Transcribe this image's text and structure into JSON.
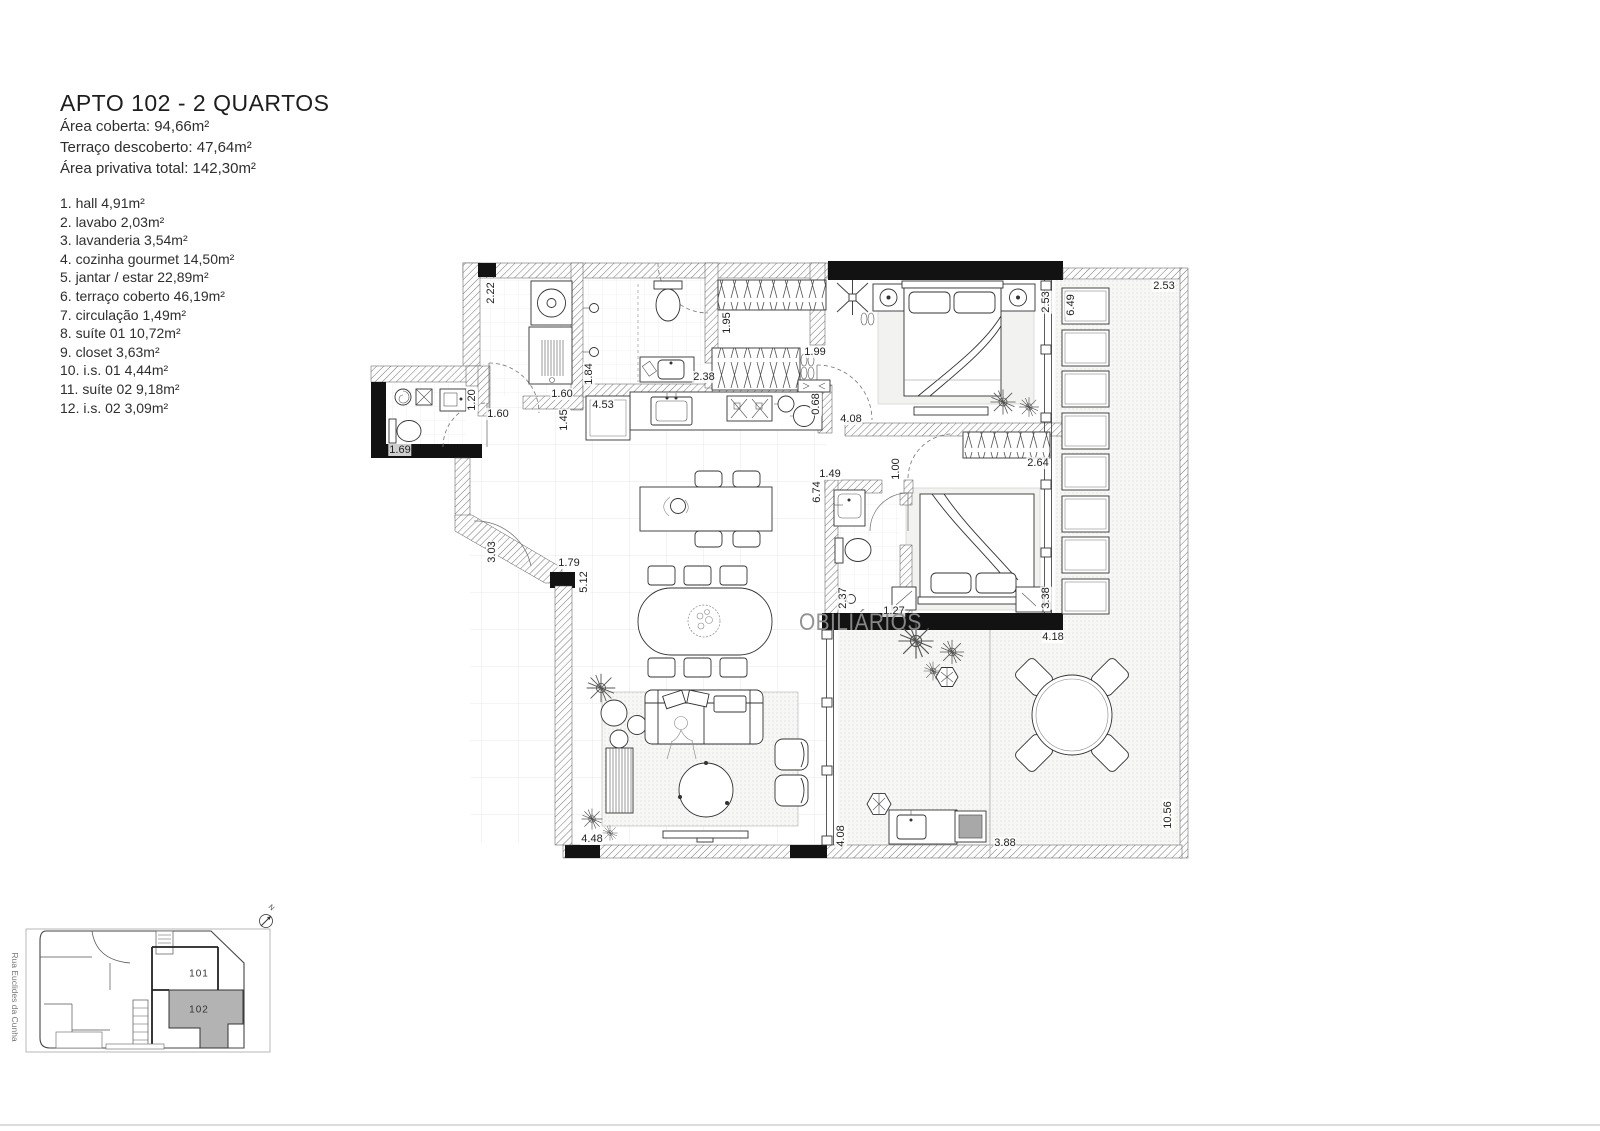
{
  "header": {
    "title": "APTO 102 - 2 QUARTOS",
    "lines": [
      "Área coberta: 94,66m²",
      "Terraço descoberto: 47,64m²",
      "Área privativa total: 142,30m²"
    ]
  },
  "room_list": {
    "items": [
      "1. hall  4,91m²",
      "2. lavabo  2,03m²",
      "3. lavanderia  3,54m²",
      "4. cozinha gourmet  14,50m²",
      "5. jantar / estar  22,89m²",
      "6. terraço coberto  46,19m²",
      "7. circulação  1,49m²",
      "8. suíte 01  10,72m²",
      "9. closet  3,63m²",
      "10. i.s. 01  4,44m²",
      "11. suíte 02  9,18m²",
      "12. i.s. 02  3,09m²"
    ]
  },
  "watermark": {
    "text": "OBILIÁRIOS"
  },
  "plan": {
    "dimensions": [
      {
        "v": "2.22",
        "x": 491,
        "y": 293,
        "r": true
      },
      {
        "v": "1.20",
        "x": 472,
        "y": 400,
        "r": true
      },
      {
        "v": "1.69",
        "x": 400,
        "y": 450
      },
      {
        "v": "1.60",
        "x": 498,
        "y": 414
      },
      {
        "v": "1.60",
        "x": 562,
        "y": 394
      },
      {
        "v": "1.45",
        "x": 564,
        "y": 420,
        "r": true
      },
      {
        "v": "1.84",
        "x": 589,
        "y": 374,
        "r": true
      },
      {
        "v": "4.53",
        "x": 603,
        "y": 405
      },
      {
        "v": "2.38",
        "x": 704,
        "y": 377
      },
      {
        "v": "1.95",
        "x": 727,
        "y": 323,
        "r": true
      },
      {
        "v": "1.99",
        "x": 815,
        "y": 352
      },
      {
        "v": "0.68",
        "x": 816,
        "y": 404,
        "r": true
      },
      {
        "v": "4.08",
        "x": 851,
        "y": 419
      },
      {
        "v": "2.53",
        "x": 1046,
        "y": 302,
        "r": true
      },
      {
        "v": "6.49",
        "x": 1071,
        "y": 305,
        "r": true
      },
      {
        "v": "2.53",
        "x": 1164,
        "y": 286
      },
      {
        "v": "2.64",
        "x": 1038,
        "y": 463
      },
      {
        "v": "1.49",
        "x": 830,
        "y": 474
      },
      {
        "v": "6.74",
        "x": 817,
        "y": 492,
        "r": true
      },
      {
        "v": "1.00",
        "x": 896,
        "y": 469,
        "r": true
      },
      {
        "v": "2.37",
        "x": 843,
        "y": 598,
        "r": true
      },
      {
        "v": "1.27",
        "x": 894,
        "y": 611
      },
      {
        "v": "3.38",
        "x": 1046,
        "y": 598,
        "r": true
      },
      {
        "v": "4.18",
        "x": 1053,
        "y": 637
      },
      {
        "v": "3.03",
        "x": 492,
        "y": 552,
        "r": true
      },
      {
        "v": "1.79",
        "x": 569,
        "y": 563
      },
      {
        "v": "5.12",
        "x": 584,
        "y": 582,
        "r": true
      },
      {
        "v": "4.48",
        "x": 592,
        "y": 839
      },
      {
        "v": "4.08",
        "x": 841,
        "y": 836,
        "r": true
      },
      {
        "v": "3.88",
        "x": 1005,
        "y": 843
      },
      {
        "v": "10.56",
        "x": 1168,
        "y": 815,
        "r": true
      }
    ]
  },
  "key_plan": {
    "street": "Rua Euclides da Cunha",
    "compass": "N",
    "units": [
      {
        "label": "101",
        "x": 199,
        "y": 974
      },
      {
        "label": "102",
        "x": 199,
        "y": 1010
      }
    ]
  }
}
